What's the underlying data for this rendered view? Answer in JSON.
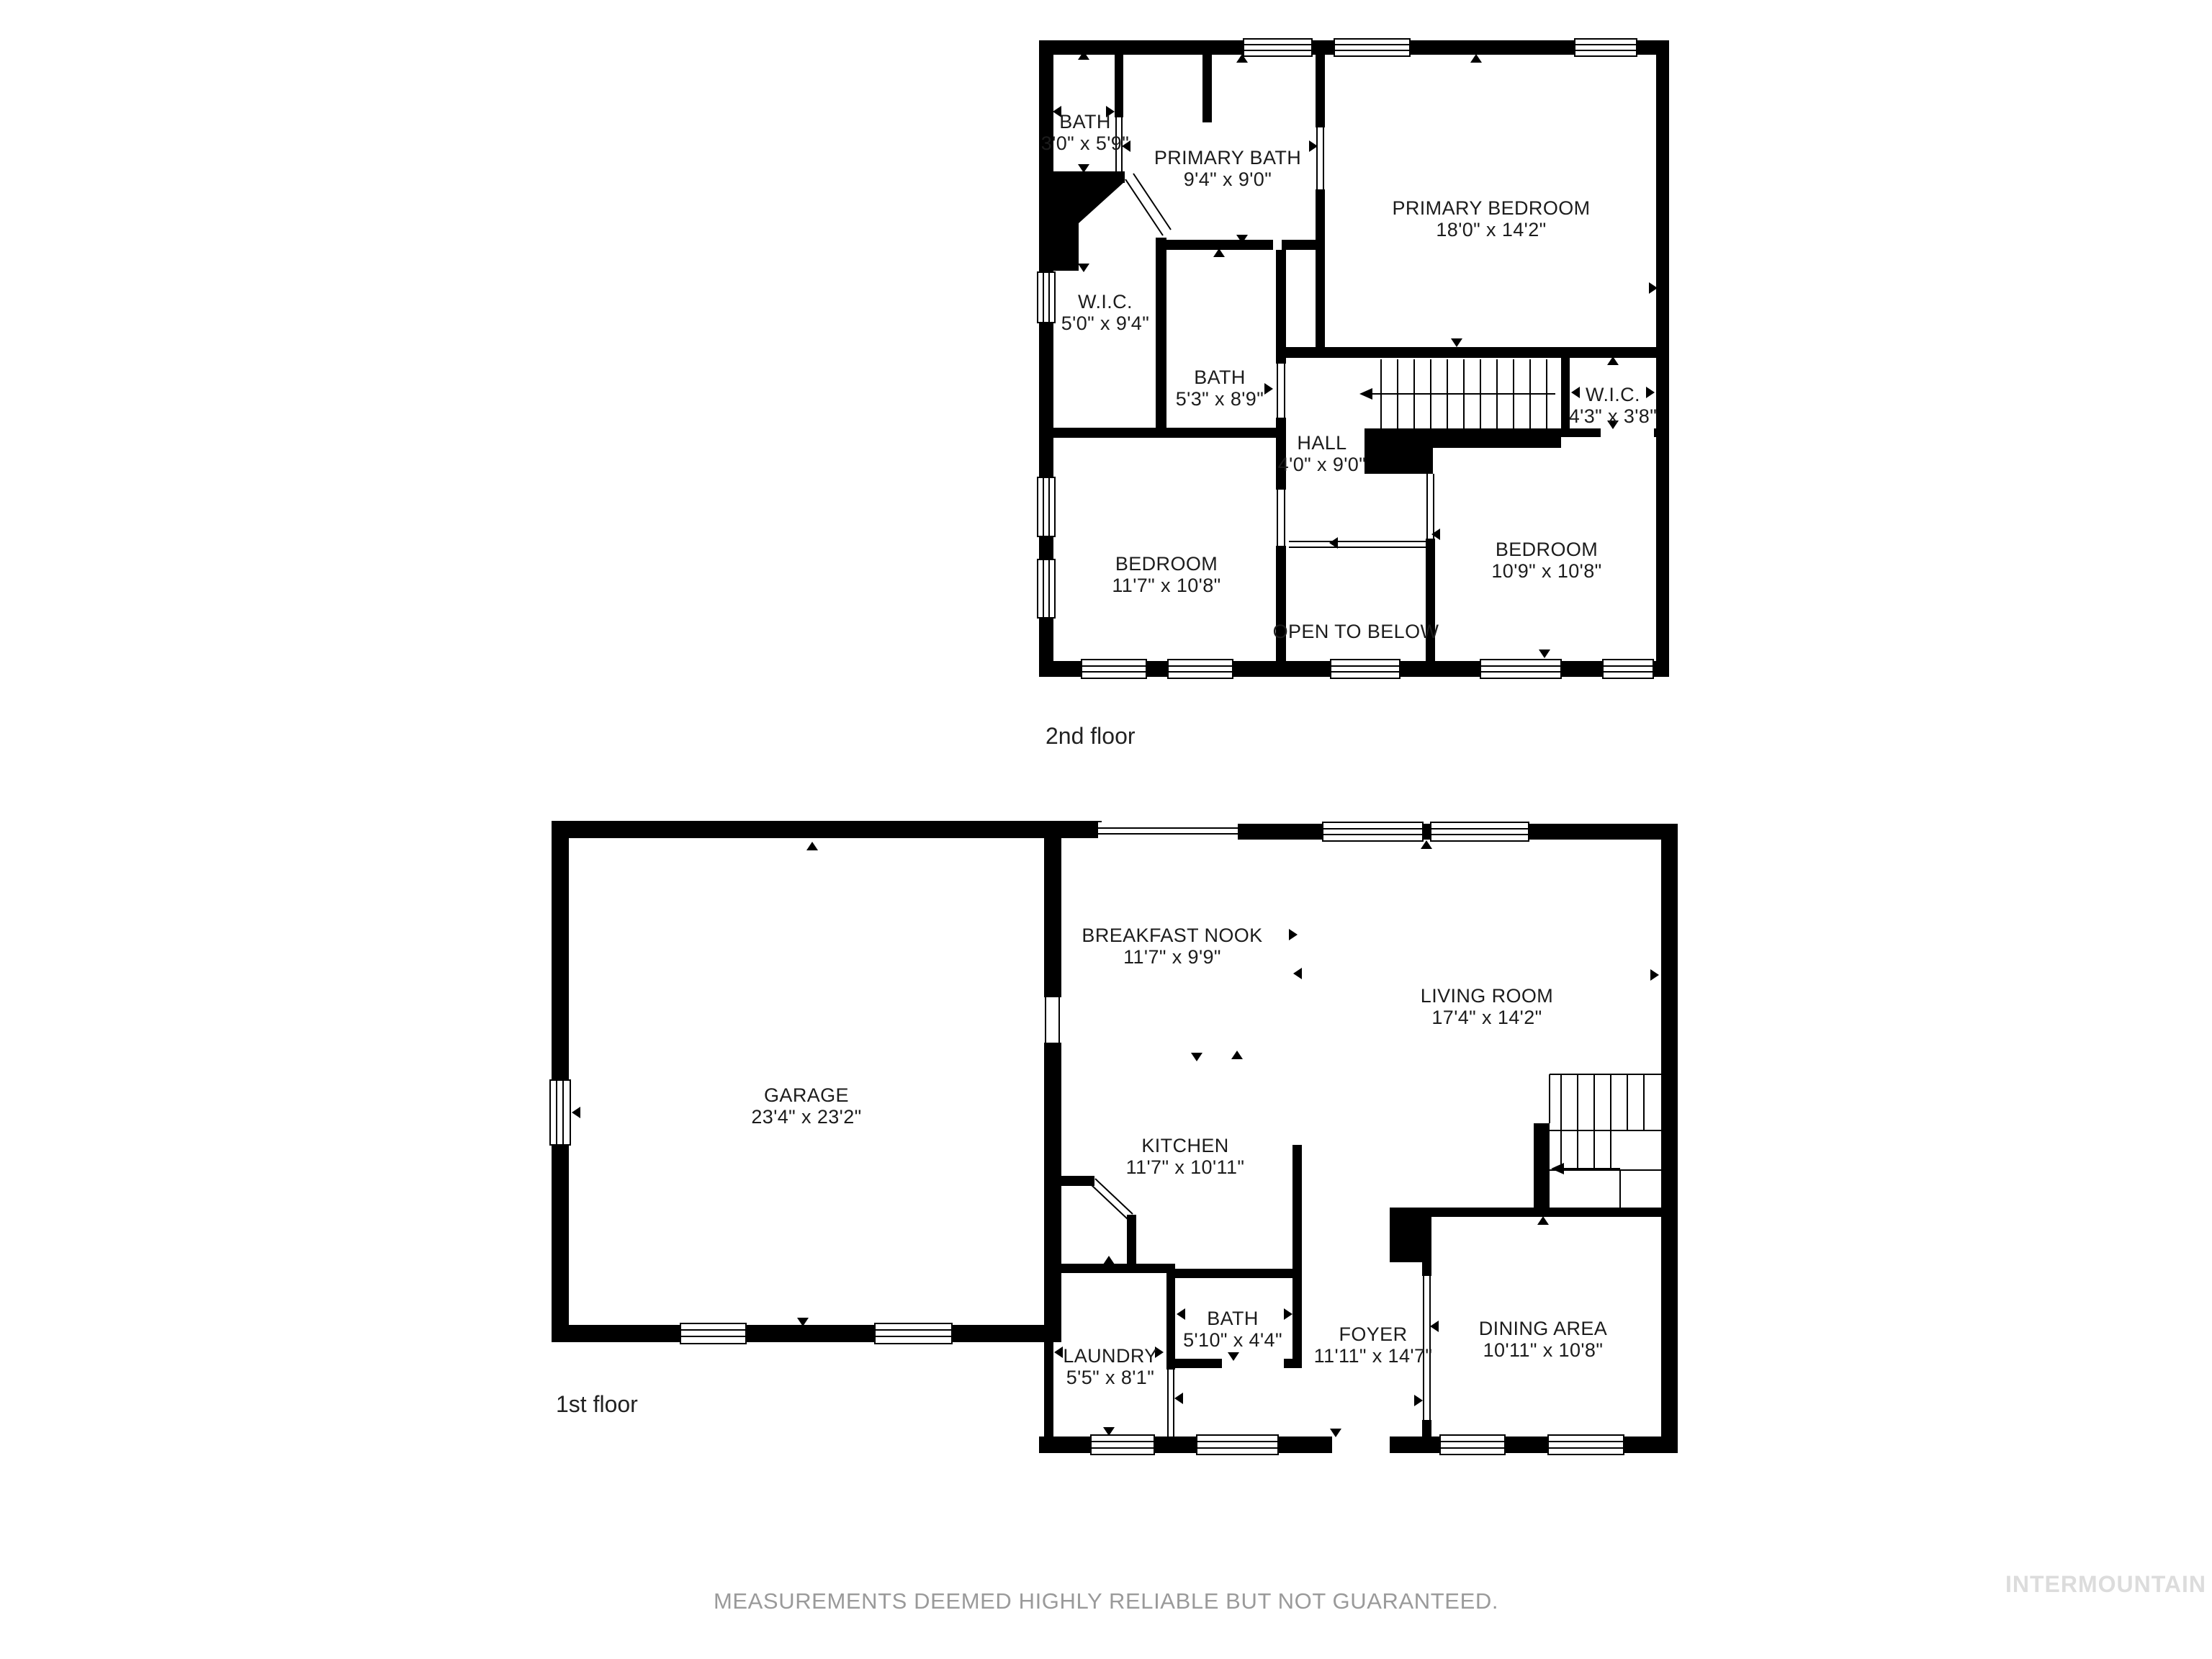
{
  "floors": [
    {
      "caption": "2nd floor",
      "rooms": [
        {
          "id": "bath-small",
          "name": "BATH",
          "dims": "3'0\" x 5'9\""
        },
        {
          "id": "primary-bath",
          "name": "PRIMARY BATH",
          "dims": "9'4\" x 9'0\""
        },
        {
          "id": "primary-bedroom",
          "name": "PRIMARY BEDROOM",
          "dims": "18'0\" x 14'2\""
        },
        {
          "id": "wic-left",
          "name": "W.I.C.",
          "dims": "5'0\" x 9'4\""
        },
        {
          "id": "bath-mid",
          "name": "BATH",
          "dims": "5'3\" x 8'9\""
        },
        {
          "id": "hall",
          "name": "HALL",
          "dims": "4'0\" x 9'0\""
        },
        {
          "id": "wic-right",
          "name": "W.I.C.",
          "dims": "4'3\" x 3'8\""
        },
        {
          "id": "bedroom-left",
          "name": "BEDROOM",
          "dims": "11'7\" x 10'8\""
        },
        {
          "id": "bedroom-right",
          "name": "BEDROOM",
          "dims": "10'9\" x 10'8\""
        },
        {
          "id": "open-to-below",
          "name": "OPEN TO BELOW",
          "dims": ""
        }
      ]
    },
    {
      "caption": "1st floor",
      "rooms": [
        {
          "id": "garage",
          "name": "GARAGE",
          "dims": "23'4\" x 23'2\""
        },
        {
          "id": "breakfast-nook",
          "name": "BREAKFAST NOOK",
          "dims": "11'7\" x 9'9\""
        },
        {
          "id": "living-room",
          "name": "LIVING ROOM",
          "dims": "17'4\" x 14'2\""
        },
        {
          "id": "kitchen",
          "name": "KITCHEN",
          "dims": "11'7\" x 10'11\""
        },
        {
          "id": "laundry",
          "name": "LAUNDRY",
          "dims": "5'5\" x 8'1\""
        },
        {
          "id": "bath",
          "name": "BATH",
          "dims": "5'10\" x 4'4\""
        },
        {
          "id": "foyer",
          "name": "FOYER",
          "dims": "11'11\" x 14'7\""
        },
        {
          "id": "dining-area",
          "name": "DINING AREA",
          "dims": "10'11\" x 10'8\""
        }
      ]
    }
  ],
  "footer": {
    "disclaimer": "MEASUREMENTS DEEMED HIGHLY RELIABLE BUT NOT GUARANTEED.",
    "watermark": "INTERMOUNTAIN"
  },
  "colors": {
    "wall": "#000000",
    "background": "#ffffff",
    "label_text": "#1c1c1c",
    "disclaimer_text": "#9a9a9a",
    "watermark_text": "#dcdcdc"
  }
}
